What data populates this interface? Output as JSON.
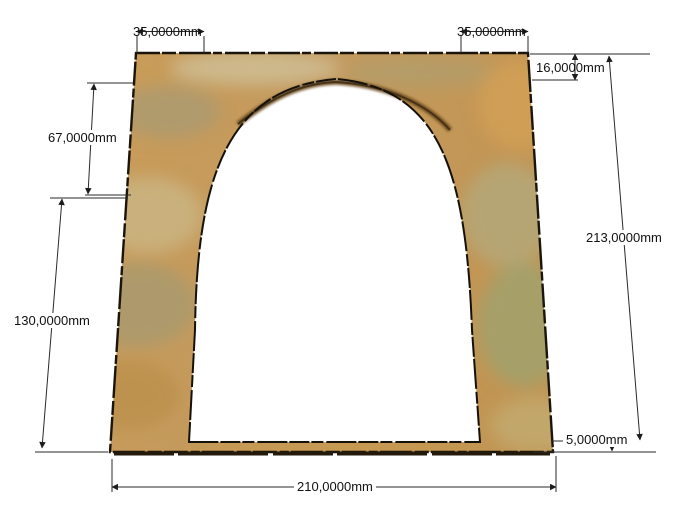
{
  "drawing": {
    "kind": "cad-dimensioned-render",
    "subject": "arched portal panel with dimension annotations",
    "units": "mm",
    "background_color": "#ffffff"
  },
  "dims": {
    "top_left_margin": {
      "label": "35,0000mm",
      "value": 35
    },
    "top_right_margin": {
      "label": "35,0000mm",
      "value": 35
    },
    "apex_drop": {
      "label": "16,0000mm",
      "value": 16
    },
    "upper_side": {
      "label": "67,0000mm",
      "value": 67
    },
    "lower_side": {
      "label": "130,0000mm",
      "value": 130
    },
    "overall_height": {
      "label": "213,0000mm",
      "value": 213
    },
    "bottom_strip": {
      "label": "5,0000mm",
      "value": 5
    },
    "overall_width": {
      "label": "210,0000mm",
      "value": 210
    }
  },
  "colors": {
    "wood_base": "#c89a55",
    "wood_olive": "#a89b74",
    "wood_beige": "#cbb584",
    "wood_green": "#9fa36e",
    "wood_orange": "#d2a055",
    "arch_inner_band": "#6e4e22",
    "outline": "#1b140a",
    "dim_line": "#2a2a2a",
    "dim_text": "#111111"
  }
}
